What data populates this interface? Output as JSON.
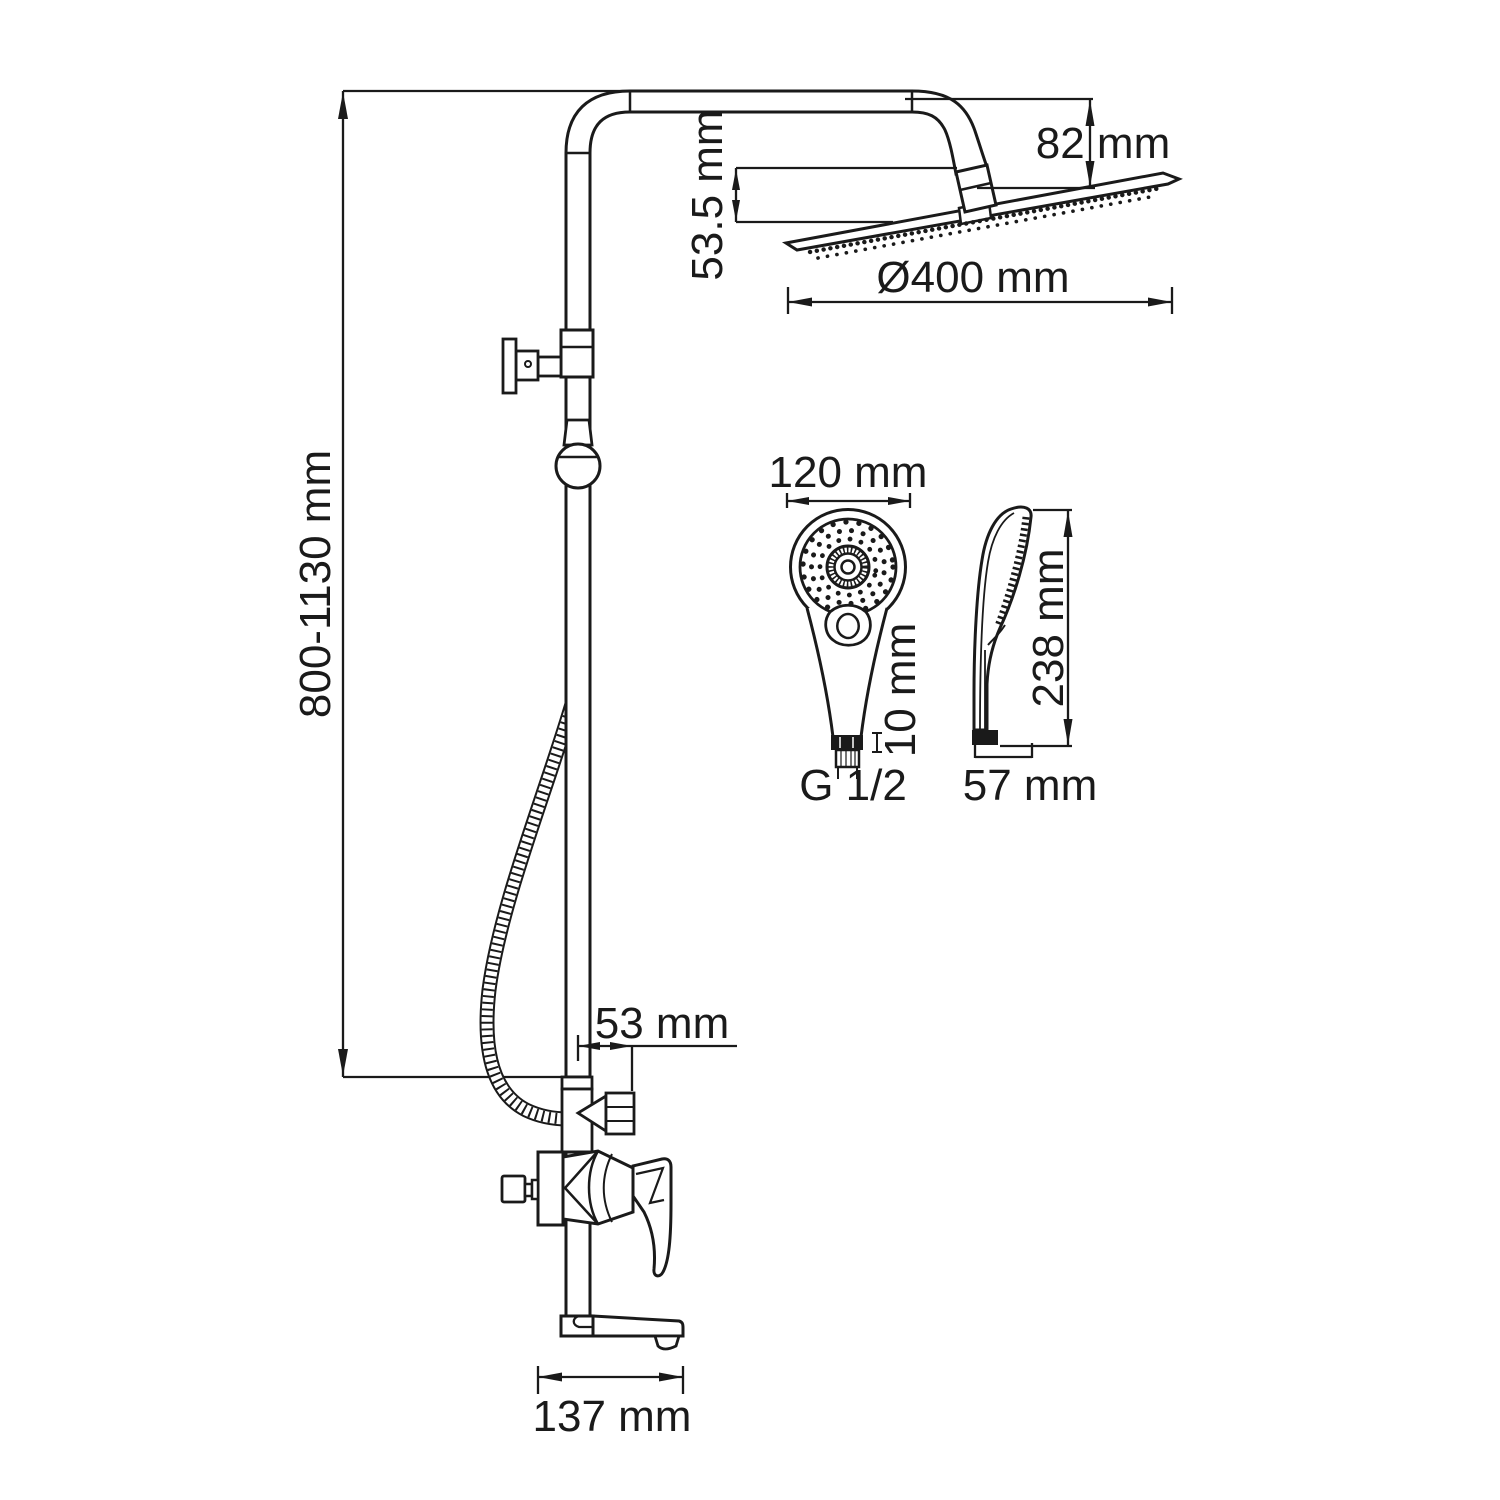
{
  "colors": {
    "line": "#1a1a1a",
    "background": "#ffffff"
  },
  "dims": {
    "overall_height": "800-1130 mm",
    "head_drop": "82 mm",
    "head_connector_offset": "53.5 mm",
    "head_diameter": "Ø400 mm",
    "hand_shower_width": "120 mm",
    "hand_shower_connector": "10 mm",
    "thread_size": "G 1/2",
    "hand_shower_height": "238 mm",
    "hand_shower_depth": "57 mm",
    "outlet_offset": "53 mm",
    "spout_projection": "137 mm"
  }
}
